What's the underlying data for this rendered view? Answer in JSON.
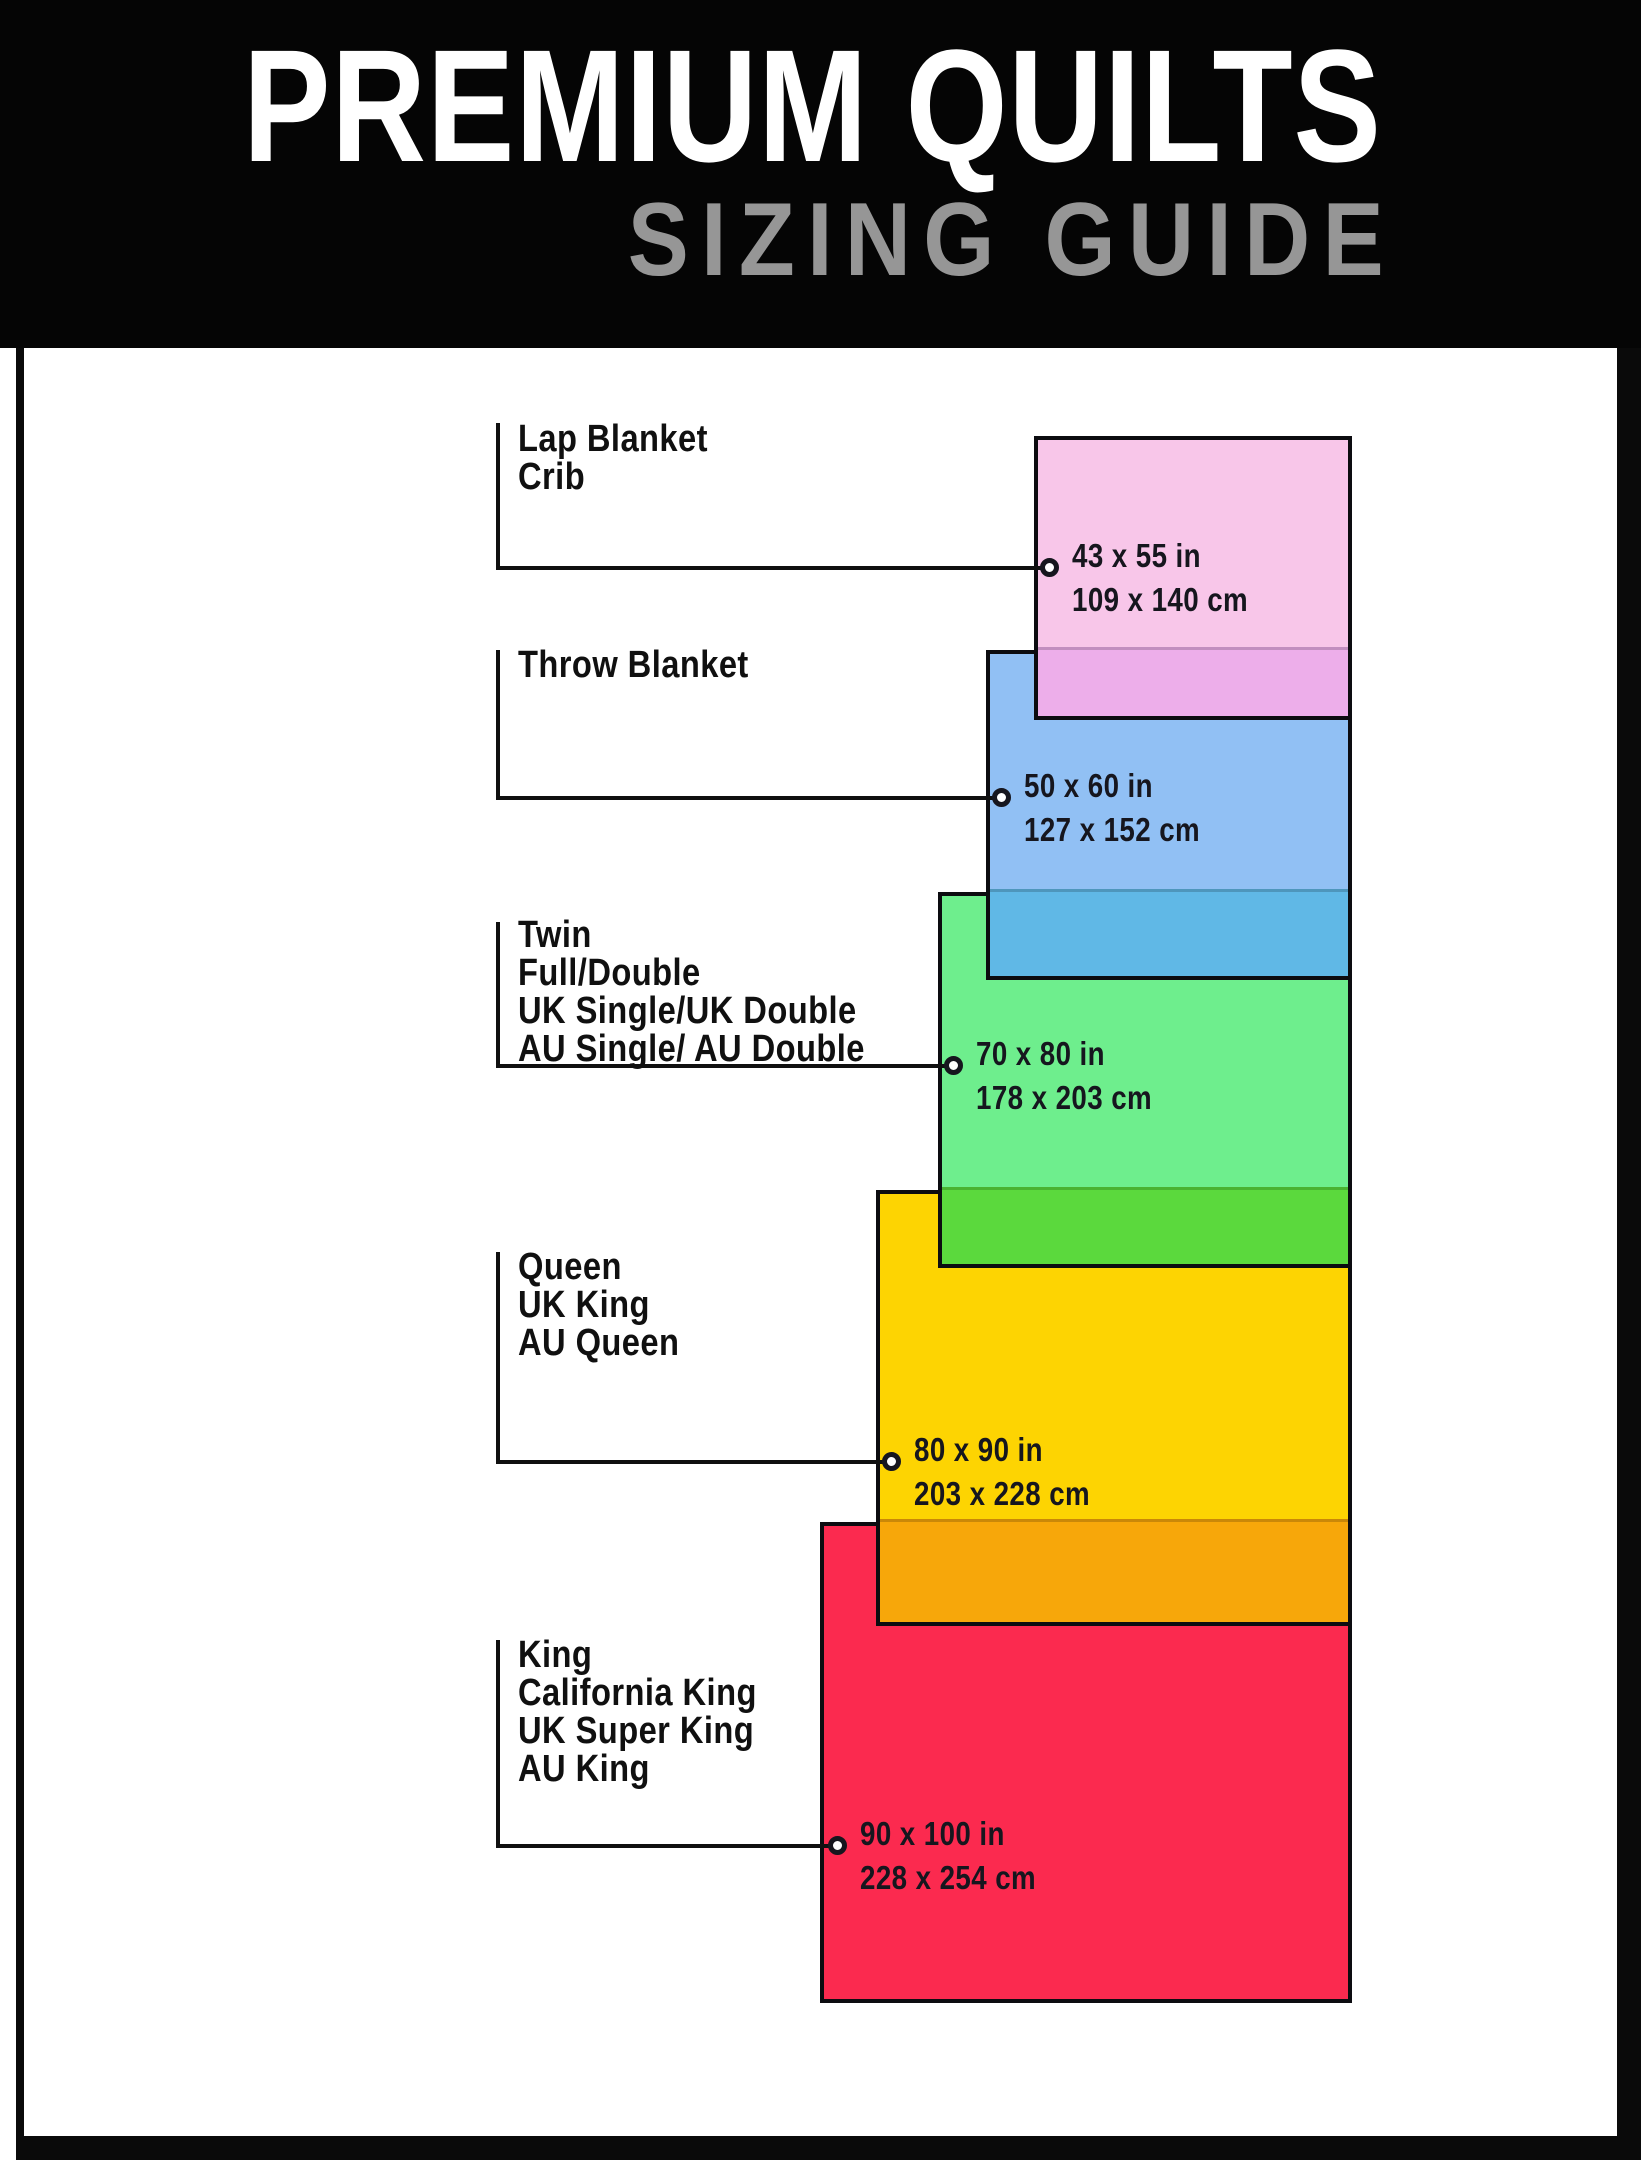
{
  "header": {
    "title": "PREMIUM QUILTS",
    "subtitle": "SIZING GUIDE"
  },
  "colors": {
    "header_bg": "#050505",
    "title": "#ffffff",
    "subtitle": "#969696",
    "frame": "#0a0a0a",
    "rect_border": "#0c0c10",
    "line": "#101010",
    "size_text": "#16161e",
    "canvas_bg": "#ffffff"
  },
  "quilts": [
    {
      "id": "lap",
      "names": [
        "Lap Blanket",
        "Crib"
      ],
      "size_in": "43 x 55 in",
      "size_cm": "109 x 140 cm",
      "fill": "#f8c6e9",
      "overlap_fill": "#edaeea"
    },
    {
      "id": "throw",
      "names": [
        "Throw Blanket"
      ],
      "size_in": "50 x 60 in",
      "size_cm": "127 x 152 cm",
      "fill": "#91c0f4",
      "overlap_fill": "#60b8e6"
    },
    {
      "id": "twin",
      "names": [
        "Twin",
        "Full/Double",
        "UK Single/UK Double",
        "AU Single/ AU Double"
      ],
      "size_in": "70 x 80 in",
      "size_cm": "178 x 203 cm",
      "fill": "#6eee8d",
      "overlap_fill": "#5bd93d"
    },
    {
      "id": "queen",
      "names": [
        "Queen",
        "UK King",
        "AU Queen"
      ],
      "size_in": "80 x 90 in",
      "size_cm": "203 x 228 cm",
      "fill": "#fdd402",
      "overlap_fill": "#f7a70a"
    },
    {
      "id": "king",
      "names": [
        "King",
        "California King",
        "UK Super King",
        "AU King"
      ],
      "size_in": "90 x 100 in",
      "size_cm": "228 x 254 cm",
      "fill": "#fb2a4f",
      "overlap_fill": null
    }
  ]
}
